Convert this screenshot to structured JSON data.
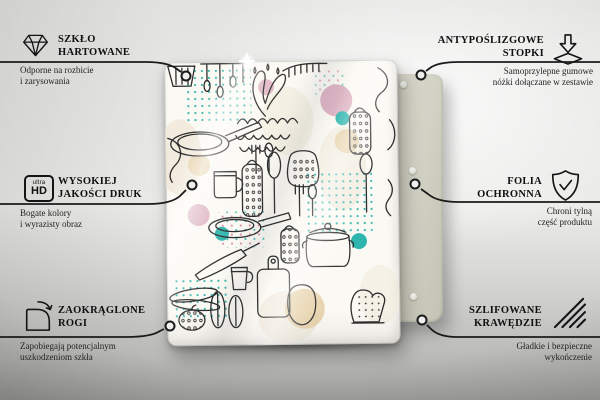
{
  "page": {
    "type": "product feature infographic"
  },
  "colors": {
    "wall": "#ebebe9",
    "floor": "#a9a9a7",
    "line": "#1b1b1b",
    "board_base": "#fbf9f3",
    "back_panel": "#d2d2c5",
    "accent_pink": "#ddb4c3",
    "accent_teal": "#2eb5ae",
    "accent_tan": "#e7d2ab",
    "dots_teal": "#3bb4ae"
  },
  "hd_icon": {
    "top": "ultra",
    "bottom": "HD"
  },
  "features": [
    {
      "id": "tempered-glass",
      "icon": "diamond-icon",
      "side": "left",
      "title_line1": "SZKŁO",
      "title_line2": "HARTOWANE",
      "desc_line1": "Odporne na rozbicie",
      "desc_line2": "i zarysowania"
    },
    {
      "id": "anti-slip-feet",
      "icon": "adhesive-feet-icon",
      "side": "right",
      "title_line1": "ANTYPOŚLIZGOWE",
      "title_line2": "STOPKI",
      "desc_line1": "Samoprzylepne gumowe",
      "desc_line2": "nóżki dołączane w zestawie"
    },
    {
      "id": "high-quality-print",
      "icon": "ultra-hd-icon",
      "side": "left",
      "title_line1": "WYSOKIEJ",
      "title_line2": "JAKOŚCI DRUK",
      "desc_line1": "Bogate kolory",
      "desc_line2": "i wyrazisty obraz"
    },
    {
      "id": "protective-film",
      "icon": "shield-check-icon",
      "side": "right",
      "title_line1": "FOLIA",
      "title_line2": "OCHRONNA",
      "desc_line1": "Chroni tylną",
      "desc_line2": "część produktu"
    },
    {
      "id": "rounded-corners",
      "icon": "rounded-corner-icon",
      "side": "left",
      "title_line1": "ZAOKRĄGLONE",
      "title_line2": "ROGI",
      "desc_line1": "Zapobiegają potencjalnym",
      "desc_line2": "uszkodzeniom szkła"
    },
    {
      "id": "polished-edges",
      "icon": "hatched-edge-icon",
      "side": "right",
      "title_line1": "SZLIFOWANE",
      "title_line2": "KRAWĘDZIE",
      "desc_line1": "Gładkie i bezpieczne",
      "desc_line2": "wykończenie"
    }
  ]
}
